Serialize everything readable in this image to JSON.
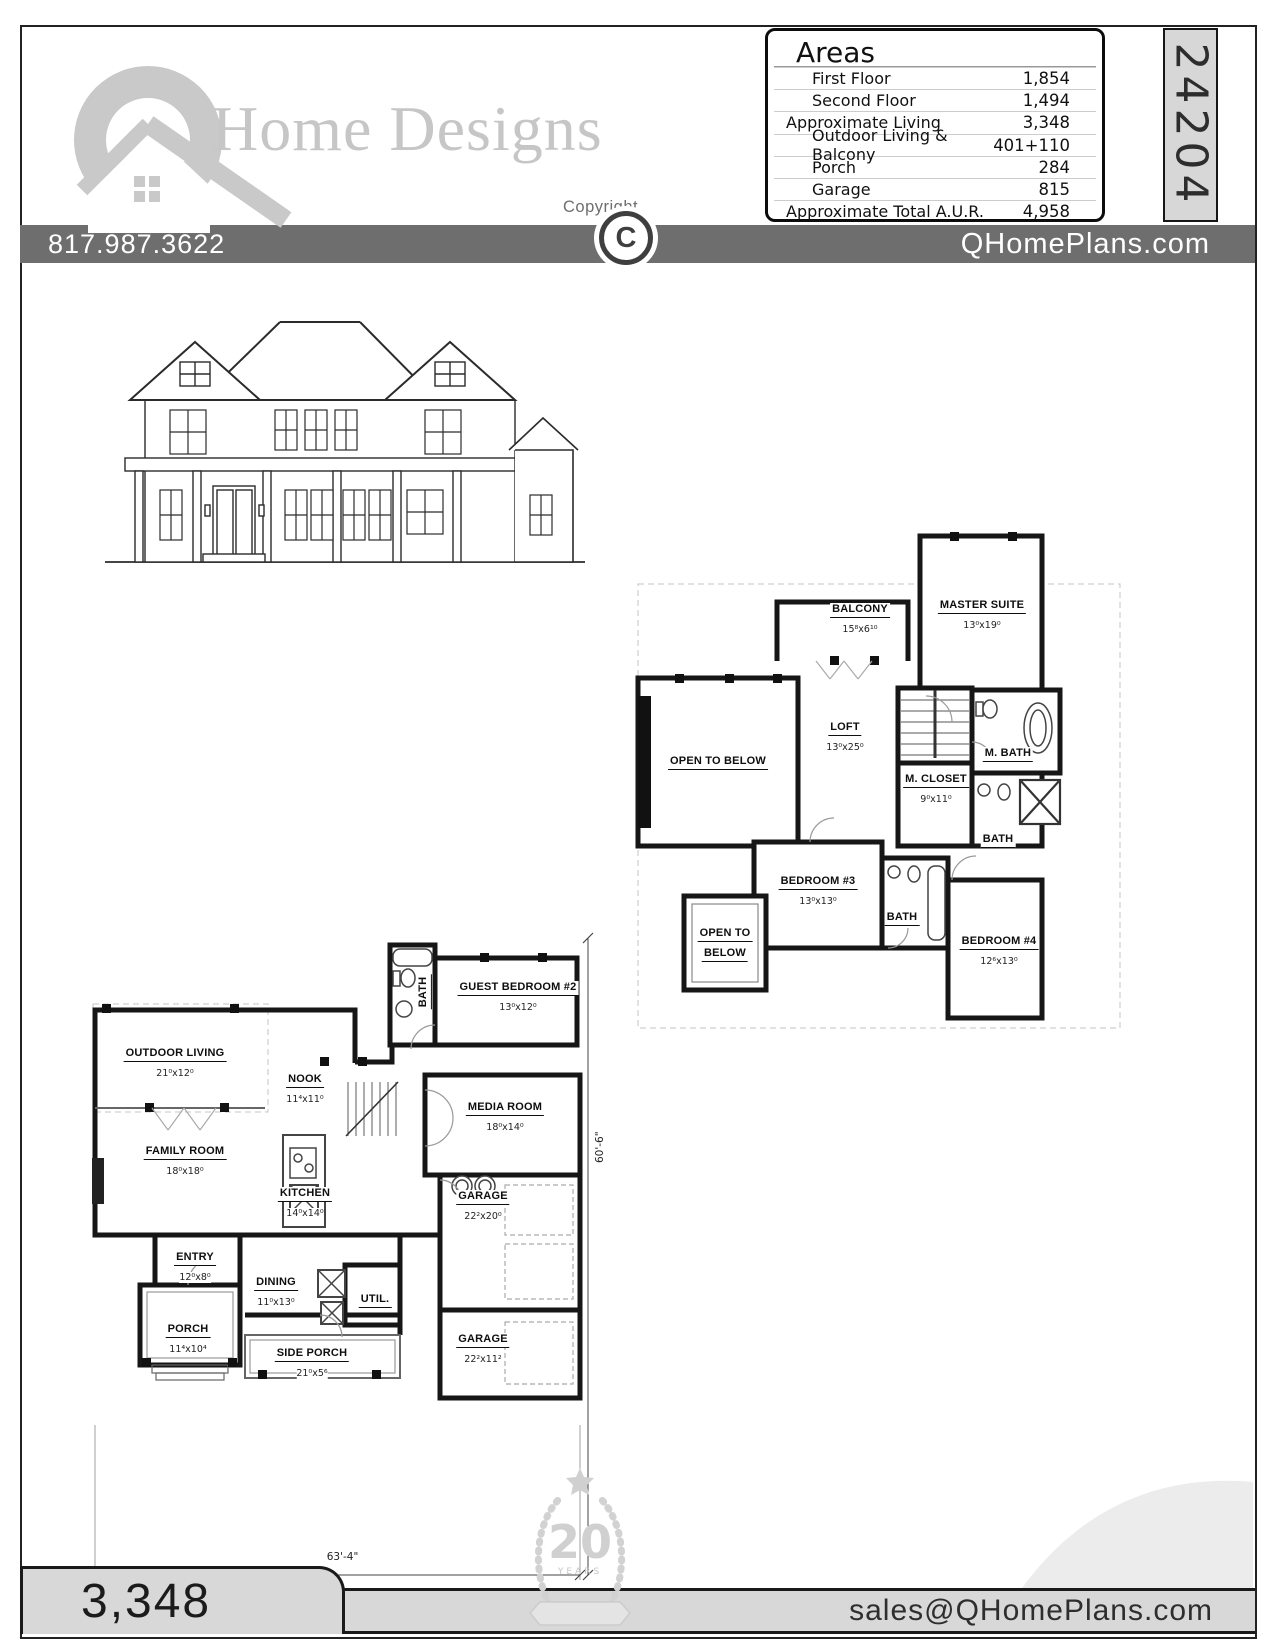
{
  "header": {
    "brand_name": "Home Designs",
    "copyright_label": "Copyright",
    "copyright_symbol": "C",
    "phone": "817.987.3622",
    "website": "QHomePlans.com",
    "plan_number": "24204"
  },
  "areas": {
    "title": "Areas",
    "rows": [
      {
        "label": "First Floor",
        "value": "1,854"
      },
      {
        "label": "Second Floor",
        "value": "1,494"
      },
      {
        "label": "Approximate Living",
        "value": "3,348"
      },
      {
        "label": "Outdoor Living & Balcony",
        "value": "401+110"
      },
      {
        "label": "Porch",
        "value": "284"
      },
      {
        "label": "Garage",
        "value": "815"
      },
      {
        "label": "Approximate Total A.U.R.",
        "value": "4,958"
      }
    ]
  },
  "second_floor": {
    "balcony": {
      "name": "BALCONY",
      "dims": "15⁸x6¹⁰"
    },
    "master": {
      "name": "MASTER SUITE",
      "dims": "13⁰x19⁰"
    },
    "loft": {
      "name": "LOFT",
      "dims": "13⁰x25⁰"
    },
    "open_below_left": {
      "name": "OPEN TO BELOW"
    },
    "m_closet": {
      "name": "M. CLOSET",
      "dims": "9⁰x11⁰"
    },
    "m_bath": {
      "name": "M. BATH"
    },
    "bath_right": {
      "name": "BATH"
    },
    "bath_mid": {
      "name": "BATH"
    },
    "bedroom3": {
      "name": "BEDROOM #3",
      "dims": "13⁰x13⁰"
    },
    "bedroom4": {
      "name": "BEDROOM #4",
      "dims": "12⁶x13⁰"
    },
    "open_below_bottom": {
      "line1": "OPEN TO",
      "line2": "BELOW"
    }
  },
  "first_floor": {
    "outdoor_living": {
      "name": "OUTDOOR LIVING",
      "dims": "21⁰x12⁰"
    },
    "nook": {
      "name": "NOOK",
      "dims": "11⁴x11⁰"
    },
    "guest_bedroom": {
      "name": "GUEST BEDROOM #2",
      "dims": "13⁰x12⁰"
    },
    "bath": {
      "name": "BATH"
    },
    "media_room": {
      "name": "MEDIA ROOM",
      "dims": "18⁰x14⁰"
    },
    "family_room": {
      "name": "FAMILY ROOM",
      "dims": "18⁰x18⁰"
    },
    "kitchen": {
      "name": "KITCHEN",
      "dims": "14⁰x14⁰"
    },
    "garage_rear": {
      "name": "GARAGE",
      "dims": "22²x20⁰"
    },
    "entry": {
      "name": "ENTRY",
      "dims": "12⁰x8⁰"
    },
    "dining": {
      "name": "DINING",
      "dims": "11⁰x13⁰"
    },
    "util": {
      "name": "UTIL."
    },
    "porch": {
      "name": "PORCH",
      "dims": "11⁴x10⁴"
    },
    "side_porch": {
      "name": "SIDE PORCH",
      "dims": "21⁰x5⁶"
    },
    "garage_side": {
      "name": "GARAGE",
      "dims": "22²x11²"
    }
  },
  "dimensions": {
    "width": "63'-4\"",
    "height": "60'-6\""
  },
  "footer": {
    "living_area": "3,348",
    "email": "sales@QHomePlans.com"
  },
  "badge": {
    "number": "20",
    "label": "YEARS"
  }
}
